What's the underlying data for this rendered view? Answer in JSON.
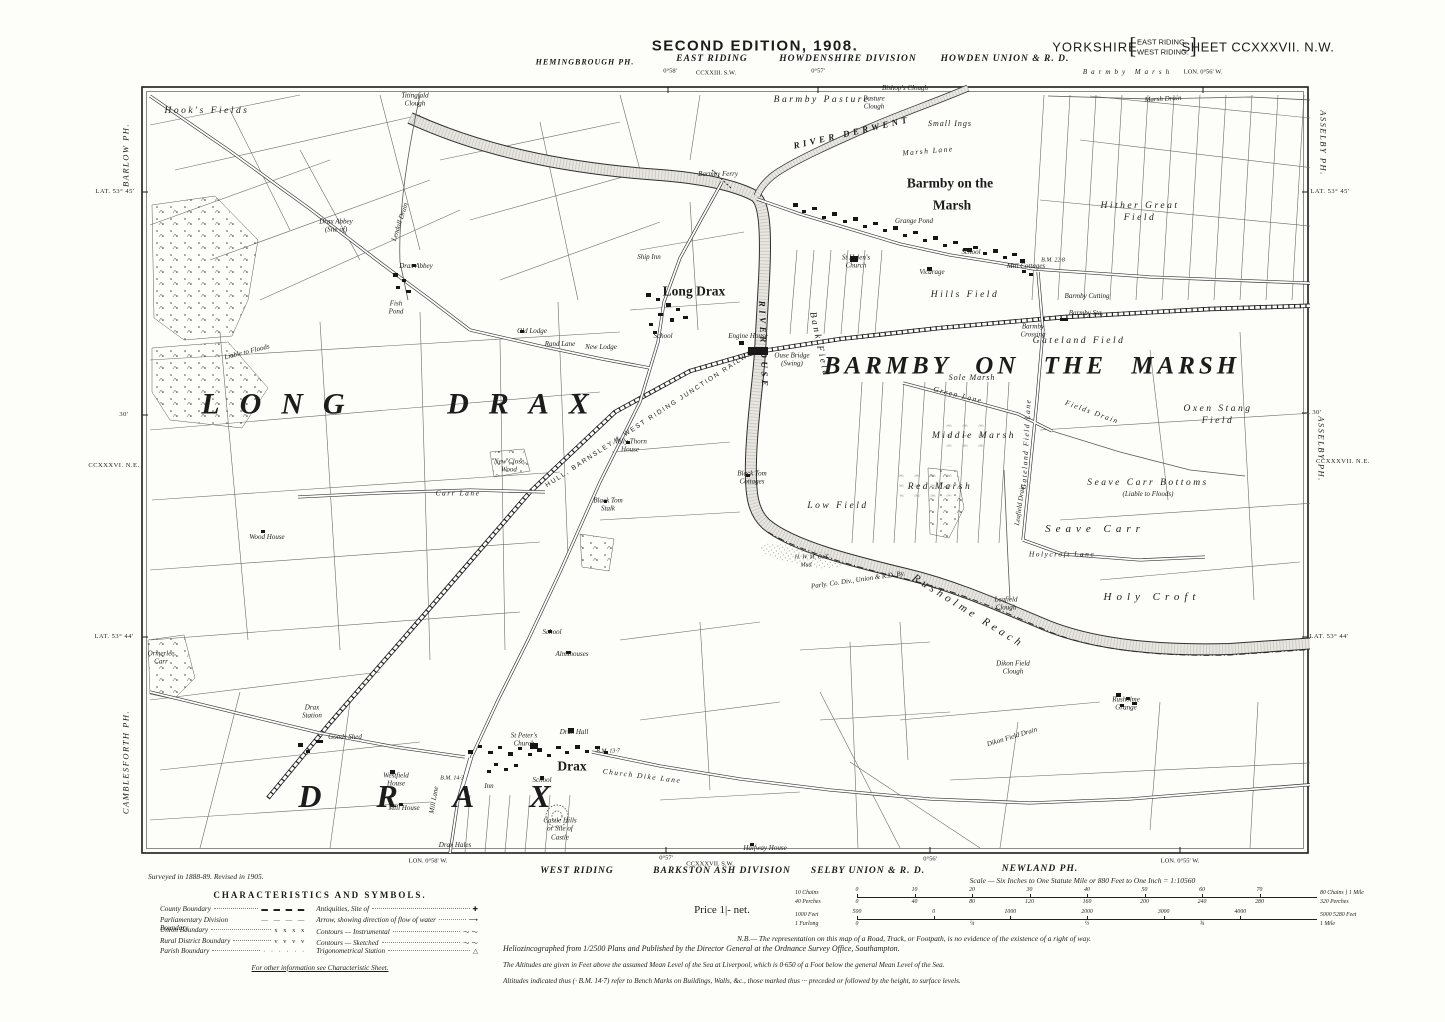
{
  "header": {
    "edition": "SECOND EDITION, 1908.",
    "riding": "EAST RIDING",
    "division": "HOWDENSHIRE DIVISION",
    "union": "HOWDEN UNION & R. D.",
    "county": "YORKSHIRE",
    "bracket_line1": "EAST RIDING.",
    "bracket_line2": "WEST RIDING.",
    "sheet": "SHEET CCXXXVII. N.W.",
    "parish_top_left": "HEMINGBROUGH PH.",
    "tick1": "0°58'",
    "adjacent_sheet": "CCXXIII. S.W.",
    "tick2": "0°57'",
    "spaced_label": "Barmby Marsh",
    "tick3": "LON. 0°56' W."
  },
  "footer": {
    "west_riding": "WEST RIDING",
    "division": "BARKSTON ASH DIVISION",
    "union": "SELBY UNION & R. D.",
    "parish": "NEWLAND PH.",
    "sheet_sw": "CCXXXVII. S.W.",
    "tick1": "LON. 0°58' W.",
    "tick2": "0°57'",
    "tick3": "0°56'",
    "tick4": "LON. 0°55' W.",
    "surveyed": "Surveyed in 1888-89. Revised in 1905.",
    "price": "Price 1|- net.",
    "legend": {
      "title": "CHARACTERISTICS AND SYMBOLS.",
      "left": [
        {
          "label": "County Boundary",
          "sample": "▬ ▬ ▬ ▬"
        },
        {
          "label": "Parliamentary Division Boundary",
          "sample": "— — — —"
        },
        {
          "label": "Union Boundary",
          "sample": "x  x  x  x"
        },
        {
          "label": "Rural District Boundary",
          "sample": "v  v  v  v"
        },
        {
          "label": "Parish Boundary",
          "sample": "·  ·  ·  ·  ·  ·"
        }
      ],
      "right": [
        {
          "label": "Antiquities, Site of",
          "sample": "✚"
        },
        {
          "label": "Arrow, showing direction of flow of water",
          "sample": "⟶"
        },
        {
          "label": "Contours — Instrumental",
          "sample": "〜〜"
        },
        {
          "label": "Contours — Sketched",
          "sample": "〜〜"
        },
        {
          "label": "Trigonometrical Station",
          "sample": "△"
        }
      ],
      "note": "For other information see Characteristic Sheet."
    },
    "scale": {
      "text": "Scale — Six Inches to One Statute Mile or 880 Feet to One Inch = 1:10560",
      "chains_left": "10 Chains",
      "chains_ticks": [
        "0",
        "10",
        "20",
        "30",
        "40",
        "50",
        "60",
        "70"
      ],
      "chains_right": "80 Chains",
      "perches_left": "40 Perches",
      "perches_ticks": [
        "0",
        "40",
        "80",
        "120",
        "160",
        "200",
        "240",
        "280"
      ],
      "perches_right": "320 Perches",
      "mile_brace": "} 1 Mile",
      "feet_left": "1000 Feet",
      "feet_ticks": [
        "500",
        "0",
        "1000",
        "2000",
        "3000",
        "4000"
      ],
      "feet_right": "5000  5280 Feet",
      "furlong_left": "1 Furlong",
      "furlong_ticks": [
        "0",
        "¼",
        "½",
        "¾"
      ],
      "furlong_right": "1 Mile"
    },
    "notes": [
      "Heliozincographed from 1/2500 Plans and Published by the Director General at the Ordnance Survey Office, Southampton.",
      "N.B.— The representation on this map of a Road, Track, or Footpath, is no evidence of the existence of a right of way.",
      "The Altitudes are given in Feet above the assumed Mean Level of the Sea at Liverpool, which is 0·650 of a Foot below the general Mean Level of the Sea.",
      "Altitudes indicated thus (· B.M. 14·7) refer to Bench Marks on Buildings, Walls, &c., those marked thus ··· preceded or followed by the height, to surface levels."
    ]
  },
  "margin_labels": [
    {
      "t": "BARLOW PH.",
      "x": 126,
      "y": 155,
      "c": "mpar",
      "r": -90
    },
    {
      "t": "LAT. 53° 45'",
      "x": 115,
      "y": 192,
      "c": "msm"
    },
    {
      "t": "30'",
      "x": 124,
      "y": 415,
      "c": "msm"
    },
    {
      "t": "CCXXXVI. N.E.",
      "x": 114,
      "y": 466,
      "c": "msm"
    },
    {
      "t": "LAT. 53° 44'",
      "x": 114,
      "y": 637,
      "c": "msm"
    },
    {
      "t": "CAMBLESFORTH PH.",
      "x": 126,
      "y": 762,
      "c": "mpar",
      "r": -90
    },
    {
      "t": "ASSELBY PH.",
      "x": 1323,
      "y": 143,
      "c": "mpar",
      "r": 90
    },
    {
      "t": "LAT. 53° 45'",
      "x": 1330,
      "y": 192,
      "c": "msm"
    },
    {
      "t": "30'",
      "x": 1317,
      "y": 413,
      "c": "msm"
    },
    {
      "t": "ASSELBY PH.",
      "x": 1321,
      "y": 449,
      "c": "mpar",
      "r": 90
    },
    {
      "t": "CCXXXVII. N.E.",
      "x": 1343,
      "y": 462,
      "c": "msm"
    },
    {
      "t": "LAT. 53° 44'",
      "x": 1329,
      "y": 637,
      "c": "msm"
    }
  ],
  "map": {
    "labels": [
      {
        "t": "LONG DRAX",
        "x": 405,
        "y": 404,
        "c": "huge",
        "fs": 30,
        "sp": 20,
        "ws": 55
      },
      {
        "t": "BARMBY ON THE MARSH",
        "x": 1032,
        "y": 366,
        "c": "huge",
        "fs": 25,
        "sp": 4,
        "ws": 14
      },
      {
        "t": "DRAX",
        "x": 452,
        "y": 796,
        "c": "huge",
        "fs": 32,
        "sp": 55
      },
      {
        "t": "Barmby on the",
        "x": 950,
        "y": 184,
        "c": "vil"
      },
      {
        "t": "Marsh",
        "x": 952,
        "y": 206,
        "c": "vil"
      },
      {
        "t": "Long Drax",
        "x": 694,
        "y": 292,
        "c": "vil"
      },
      {
        "t": "Drax",
        "x": 572,
        "y": 767,
        "c": "vil"
      },
      {
        "t": "Hook's Fields",
        "x": 207,
        "y": 112,
        "c": "field"
      },
      {
        "t": "Barmby Pasture",
        "x": 822,
        "y": 101,
        "c": "field"
      },
      {
        "t": "Hither Great\nField",
        "x": 1140,
        "y": 213,
        "c": "field"
      },
      {
        "t": "Small Ings",
        "x": 950,
        "y": 124,
        "c": "small"
      },
      {
        "t": "Marsh Lane",
        "x": 928,
        "y": 151,
        "c": "lane",
        "r": -5
      },
      {
        "t": "Hills Field",
        "x": 965,
        "y": 296,
        "c": "field"
      },
      {
        "t": "Gateland Field",
        "x": 1079,
        "y": 342,
        "c": "field"
      },
      {
        "t": "Sole Marsh",
        "x": 972,
        "y": 378,
        "c": "small"
      },
      {
        "t": "Middle Marsh",
        "x": 974,
        "y": 437,
        "c": "field"
      },
      {
        "t": "Red Marsh",
        "x": 940,
        "y": 488,
        "c": "field"
      },
      {
        "t": "Low Field",
        "x": 838,
        "y": 507,
        "c": "field"
      },
      {
        "t": "Oxen Stang\nField",
        "x": 1218,
        "y": 416,
        "c": "field"
      },
      {
        "t": "Seave Carr Bottoms",
        "x": 1148,
        "y": 484,
        "c": "field"
      },
      {
        "t": "(Liable to Floods)",
        "x": 1148,
        "y": 494,
        "c": "tiny"
      },
      {
        "t": "Seave Carr",
        "x": 1095,
        "y": 530,
        "c": "field2"
      },
      {
        "t": "Holy Croft",
        "x": 1152,
        "y": 598,
        "c": "field2"
      },
      {
        "t": "Bank Field",
        "x": 818,
        "y": 345,
        "c": "field",
        "r": 78
      },
      {
        "t": "Holycroft Lane",
        "x": 1062,
        "y": 554,
        "c": "lane"
      },
      {
        "t": "Green Lane",
        "x": 958,
        "y": 395,
        "c": "lane",
        "r": 14
      },
      {
        "t": "Fields Drain",
        "x": 1092,
        "y": 412,
        "c": "lane",
        "r": 20
      },
      {
        "t": "Gateland Field Lane",
        "x": 1026,
        "y": 444,
        "c": "lane",
        "r": -87
      },
      {
        "t": "Leafield Drain",
        "x": 1020,
        "y": 505,
        "c": "tiny",
        "r": -82
      },
      {
        "t": "Carr Lane",
        "x": 458,
        "y": 493,
        "c": "lane"
      },
      {
        "t": "Church Dike Lane",
        "x": 642,
        "y": 776,
        "c": "lane",
        "r": 7
      },
      {
        "t": "Mill Lane",
        "x": 434,
        "y": 800,
        "c": "tiny",
        "r": -80
      },
      {
        "t": "Marsh Drain",
        "x": 1163,
        "y": 99,
        "c": "tiny",
        "r": -3
      },
      {
        "t": "Lendall Drain",
        "x": 400,
        "y": 222,
        "c": "tiny",
        "r": -72
      },
      {
        "t": "RIVER DERWENT",
        "x": 852,
        "y": 133,
        "c": "river",
        "r": -13
      },
      {
        "t": "RIVER OUSE",
        "x": 763,
        "y": 345,
        "c": "river",
        "r": 88
      },
      {
        "t": "Rusholme Reach",
        "x": 968,
        "y": 612,
        "c": "river2",
        "r": 32
      },
      {
        "t": "HULL, BARNSLEY & WEST RIDING JUNCTION RAILWAY",
        "x": 652,
        "y": 418,
        "c": "rail",
        "r": -33
      },
      {
        "t": "Parly. Co. Div., Union & R.D. By.",
        "x": 858,
        "y": 580,
        "c": "tiny",
        "r": -8
      },
      {
        "t": "H. W. M. O. T.",
        "x": 812,
        "y": 558,
        "c": "bm"
      },
      {
        "t": "Mud",
        "x": 806,
        "y": 566,
        "c": "bm"
      },
      {
        "t": "Barmby Ferry",
        "x": 718,
        "y": 174,
        "c": "tiny"
      },
      {
        "t": "Bishop's Clough",
        "x": 905,
        "y": 88,
        "c": "tiny"
      },
      {
        "t": "Pasture\nClough",
        "x": 874,
        "y": 103,
        "c": "tiny"
      },
      {
        "t": "Grange Pond",
        "x": 914,
        "y": 221,
        "c": "tiny"
      },
      {
        "t": "St Helen's\nChurch",
        "x": 856,
        "y": 262,
        "c": "tiny"
      },
      {
        "t": "School",
        "x": 971,
        "y": 252,
        "c": "tiny"
      },
      {
        "t": "Vicarage",
        "x": 932,
        "y": 272,
        "c": "tiny"
      },
      {
        "t": "Mill Cottages",
        "x": 1026,
        "y": 266,
        "c": "tiny"
      },
      {
        "t": "Barmby Cutting",
        "x": 1087,
        "y": 296,
        "c": "tiny"
      },
      {
        "t": "Barmby Sta.",
        "x": 1086,
        "y": 313,
        "c": "tiny"
      },
      {
        "t": "Barmby\nCrossing",
        "x": 1033,
        "y": 331,
        "c": "tiny"
      },
      {
        "t": "Ship Inn",
        "x": 649,
        "y": 257,
        "c": "tiny"
      },
      {
        "t": "School",
        "x": 663,
        "y": 336,
        "c": "tiny"
      },
      {
        "t": "Engine House",
        "x": 748,
        "y": 336,
        "c": "tiny"
      },
      {
        "t": "Ouse Bridge\n(Swing)",
        "x": 792,
        "y": 360,
        "c": "tiny"
      },
      {
        "t": "Old Lodge",
        "x": 532,
        "y": 331,
        "c": "tiny"
      },
      {
        "t": "Rand Lane",
        "x": 560,
        "y": 344,
        "c": "tiny"
      },
      {
        "t": "New Lodge",
        "x": 601,
        "y": 347,
        "c": "tiny"
      },
      {
        "t": "Drax Abbey\n(Site of)",
        "x": 336,
        "y": 226,
        "c": "tiny"
      },
      {
        "t": "Drax Abbey",
        "x": 416,
        "y": 266,
        "c": "tiny"
      },
      {
        "t": "Fish\nPond",
        "x": 396,
        "y": 308,
        "c": "tiny"
      },
      {
        "t": "Titingfald\nClough",
        "x": 415,
        "y": 100,
        "c": "tiny"
      },
      {
        "t": "New Close\nWood",
        "x": 509,
        "y": 466,
        "c": "tiny"
      },
      {
        "t": "Nelly Thorn\nHouse",
        "x": 630,
        "y": 446,
        "c": "tiny"
      },
      {
        "t": "Black Tom\nCottages",
        "x": 752,
        "y": 478,
        "c": "tiny"
      },
      {
        "t": "Black Tom\nStalk",
        "x": 608,
        "y": 505,
        "c": "tiny"
      },
      {
        "t": "Wood House",
        "x": 267,
        "y": 537,
        "c": "tiny"
      },
      {
        "t": "School",
        "x": 552,
        "y": 632,
        "c": "tiny"
      },
      {
        "t": "Almshouses",
        "x": 572,
        "y": 654,
        "c": "tiny"
      },
      {
        "t": "Drax\nStation",
        "x": 312,
        "y": 712,
        "c": "tiny"
      },
      {
        "t": "Goods Shed",
        "x": 345,
        "y": 737,
        "c": "tiny"
      },
      {
        "t": "Westfield\nHouse",
        "x": 396,
        "y": 780,
        "c": "tiny"
      },
      {
        "t": "Mill House",
        "x": 404,
        "y": 808,
        "c": "tiny"
      },
      {
        "t": "St Peter's\nChurch",
        "x": 524,
        "y": 740,
        "c": "tiny"
      },
      {
        "t": "Drax Hall",
        "x": 574,
        "y": 732,
        "c": "tiny"
      },
      {
        "t": "School",
        "x": 542,
        "y": 780,
        "c": "tiny"
      },
      {
        "t": "Inn",
        "x": 489,
        "y": 786,
        "c": "tiny"
      },
      {
        "t": "Castle Hills\nor Site of\nCastle",
        "x": 560,
        "y": 829,
        "c": "tiny"
      },
      {
        "t": "Drax Hales",
        "x": 455,
        "y": 845,
        "c": "tiny"
      },
      {
        "t": "Halfway House",
        "x": 765,
        "y": 848,
        "c": "tiny"
      },
      {
        "t": "Dikon Field\nClough",
        "x": 1013,
        "y": 668,
        "c": "tiny"
      },
      {
        "t": "Dikon Field Drain",
        "x": 1012,
        "y": 737,
        "c": "tiny",
        "r": -17
      },
      {
        "t": "Rusholme\nGrange",
        "x": 1126,
        "y": 704,
        "c": "tiny"
      },
      {
        "t": "Leafield\nClough",
        "x": 1006,
        "y": 604,
        "c": "tiny"
      },
      {
        "t": "Ormerlee\nCarr",
        "x": 161,
        "y": 658,
        "c": "tiny"
      },
      {
        "t": "Liable to Floods",
        "x": 247,
        "y": 352,
        "c": "tiny",
        "r": -14
      },
      {
        "t": "B.M. 22·8",
        "x": 1053,
        "y": 261,
        "c": "bm"
      },
      {
        "t": "B.M. 13·7",
        "x": 608,
        "y": 752,
        "c": "bm"
      },
      {
        "t": "B.M. 14·3",
        "x": 452,
        "y": 779,
        "c": "bm"
      }
    ]
  }
}
